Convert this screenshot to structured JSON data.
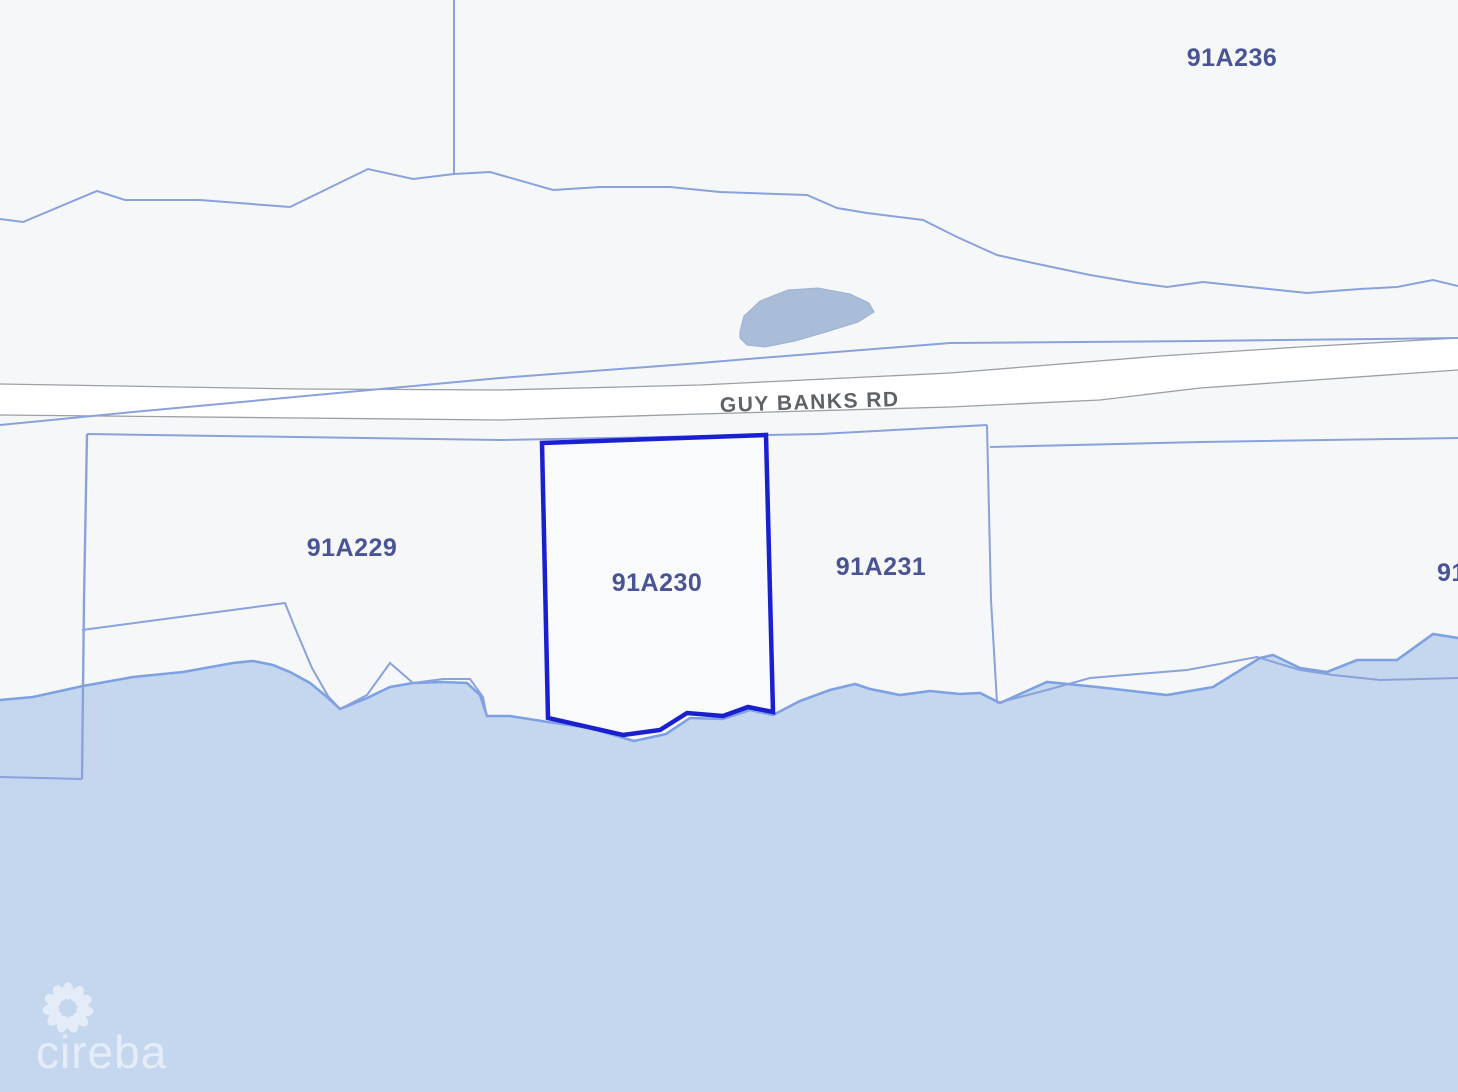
{
  "map": {
    "road": {
      "label": "GUY BANKS RD"
    },
    "parcels": [
      {
        "id": "91A236"
      },
      {
        "id": "91A229"
      },
      {
        "id": "91A230",
        "selected": true
      },
      {
        "id": "91A231"
      },
      {
        "id": "91"
      }
    ],
    "selected_parcel_id": "91A230",
    "colors": {
      "land": "#f6f7f9",
      "water": "#c5d7ef",
      "coastline": "#7da1e3",
      "boundary": "#8aa2dc",
      "road_casing": "#9aa0a6",
      "road_fill": "#ffffff",
      "pond_fill": "#a9bdd9",
      "pond_edge": "#9db1d1",
      "selected_outline": "#1a1fd0",
      "parcel_label": "#4a5494",
      "road_label": "#5f6368",
      "watermark": "#ffffff"
    }
  },
  "watermark": {
    "brand": "cireba"
  }
}
